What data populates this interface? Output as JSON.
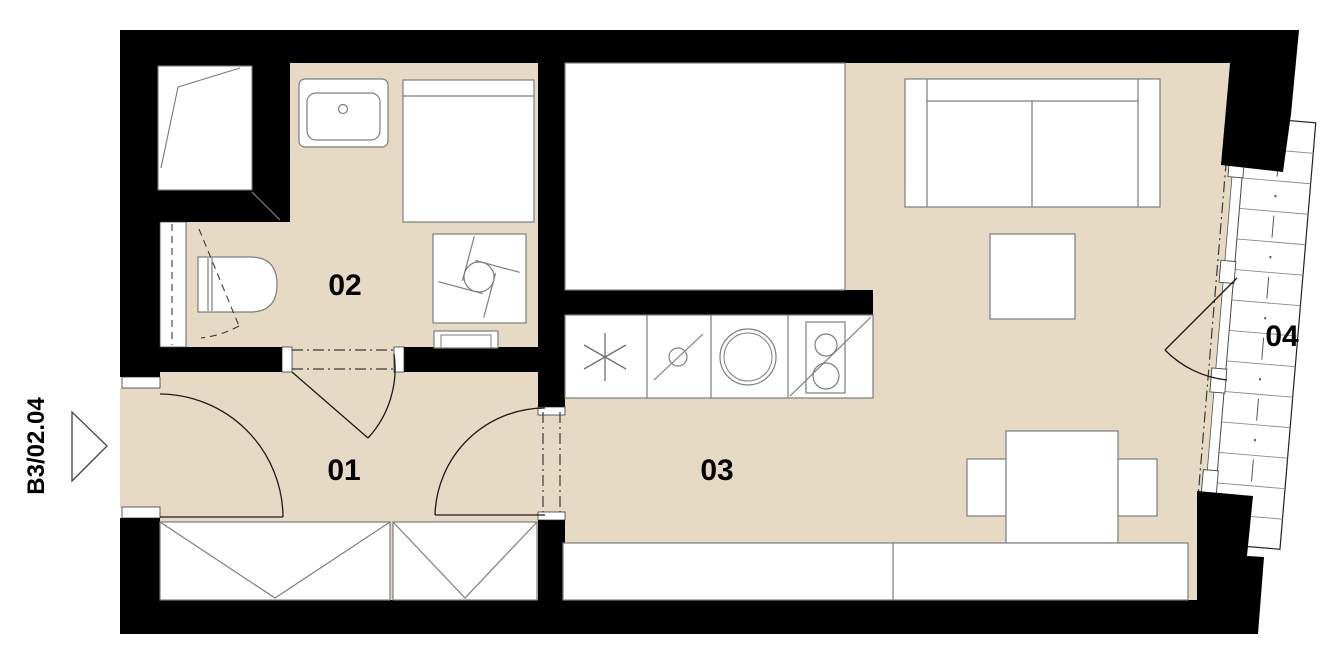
{
  "plan": {
    "unit_label": "B3/02.04",
    "rooms": [
      {
        "number": "01",
        "name": "entrance-hall"
      },
      {
        "number": "02",
        "name": "bathroom"
      },
      {
        "number": "03",
        "name": "living-room-with-kitchenette"
      },
      {
        "number": "04",
        "name": "balcony"
      }
    ],
    "colors": {
      "floor": "#e6dac4",
      "wall": "#000000",
      "furniture_outline": "#7d7d7d",
      "background": "#ffffff",
      "label_text": "#000000"
    },
    "fixtures": {
      "bathroom": [
        "shower",
        "washbasin",
        "toilet",
        "installation-shaft",
        "bathtub",
        "washing-machine",
        "towel-radiator"
      ],
      "kitchen": [
        "fridge-freezer",
        "base-cabinet",
        "kitchen-sink",
        "cooktop"
      ],
      "living": [
        "bed",
        "sofa",
        "coffee-table",
        "dining-table",
        "chair",
        "chair",
        "sideboard"
      ],
      "hall": [
        "wardrobe",
        "wardrobe"
      ],
      "balcony": [
        "timber-decking",
        "glazed-wall",
        "balcony-door"
      ]
    },
    "entrance_marker": {
      "icon": "entrance-arrow-icon",
      "label_ref": "unit_label"
    }
  }
}
